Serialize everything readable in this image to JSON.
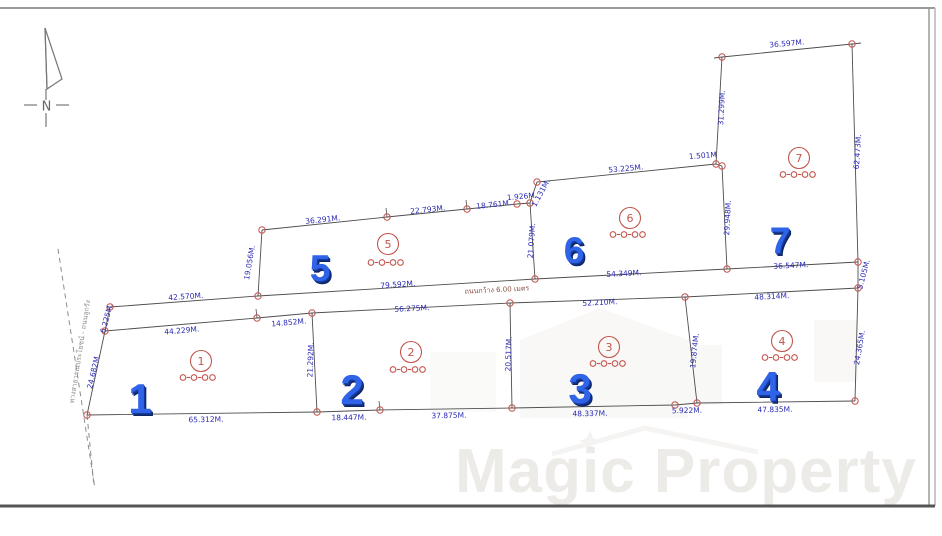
{
  "compass": {
    "label": "N"
  },
  "watermark": {
    "text": "Magic Property"
  },
  "roads": {
    "internal_road_label": "ถนนกว้าง 6.00 เมตร",
    "frontage_road_label": "ทางสาธารณประโยชน์ - ถนนลูกรัง"
  },
  "colors": {
    "dimension_text": "#2b2bb4",
    "survey_marker": "#c2554d",
    "plot_number_blue": "#2f63e8",
    "boundary_line": "#4d4d4d",
    "watermark_gray": "#edebe8"
  },
  "plots": [
    {
      "number": "1",
      "circled_number": "1",
      "area_rai_ngan_wah": "๐-๐-๐๐",
      "number_pos": [
        140,
        413
      ],
      "circle_pos": [
        201,
        361
      ],
      "area_pos": [
        200,
        380
      ]
    },
    {
      "number": "2",
      "circled_number": "2",
      "area_rai_ngan_wah": "๐-๐-๐๐",
      "number_pos": [
        352,
        404
      ],
      "circle_pos": [
        411,
        352
      ],
      "area_pos": [
        410,
        372
      ]
    },
    {
      "number": "3",
      "circled_number": "3",
      "area_rai_ngan_wah": "๐-๐-๐๐",
      "number_pos": [
        580,
        403
      ],
      "circle_pos": [
        609,
        347
      ],
      "area_pos": [
        610,
        366
      ]
    },
    {
      "number": "4",
      "circled_number": "4",
      "area_rai_ngan_wah": "๐-๐-๐๐",
      "number_pos": [
        768,
        401
      ],
      "circle_pos": [
        782,
        341
      ],
      "area_pos": [
        782,
        360
      ]
    },
    {
      "number": "5",
      "circled_number": "5",
      "area_rai_ngan_wah": "๐-๐-๐๐",
      "number_pos": [
        320,
        281
      ],
      "circle_pos": [
        388,
        244
      ],
      "area_pos": [
        388,
        265
      ]
    },
    {
      "number": "6",
      "circled_number": "6",
      "area_rai_ngan_wah": "๐-๐-๐๐",
      "number_pos": [
        574,
        263
      ],
      "circle_pos": [
        630,
        218
      ],
      "area_pos": [
        630,
        237
      ]
    },
    {
      "number": "7",
      "circled_number": "7",
      "area_rai_ngan_wah": "๐-๐-๐๐",
      "number_pos": [
        780,
        253
      ],
      "circle_pos": [
        799,
        158
      ],
      "area_pos": [
        800,
        177
      ]
    }
  ],
  "dimensions": [
    {
      "text": "42.570M.",
      "x": 186,
      "y": 299,
      "rot": -4
    },
    {
      "text": "79.592M.",
      "x": 398,
      "y": 287,
      "rot": -4
    },
    {
      "text": "54.349M.",
      "x": 624,
      "y": 276,
      "rot": -3
    },
    {
      "text": "36.547M.",
      "x": 791,
      "y": 268,
      "rot": -3
    },
    {
      "text": "44.229M.",
      "x": 182,
      "y": 333,
      "rot": -5
    },
    {
      "text": "14.852M.",
      "x": 289,
      "y": 325,
      "rot": -5
    },
    {
      "text": "56.275M.",
      "x": 412,
      "y": 311,
      "rot": -3
    },
    {
      "text": "52.210M.",
      "x": 600,
      "y": 305,
      "rot": -3
    },
    {
      "text": "48.314M.",
      "x": 772,
      "y": 299,
      "rot": -3
    },
    {
      "text": "65.312M.",
      "x": 206,
      "y": 422,
      "rot": -1
    },
    {
      "text": "18.447M.",
      "x": 349,
      "y": 420,
      "rot": -1
    },
    {
      "text": "37.875M.",
      "x": 449,
      "y": 418,
      "rot": -1
    },
    {
      "text": "48.337M.",
      "x": 590,
      "y": 416,
      "rot": -1
    },
    {
      "text": "5.922M.",
      "x": 687,
      "y": 413,
      "rot": -1
    },
    {
      "text": "47.835M.",
      "x": 775,
      "y": 412,
      "rot": -1
    },
    {
      "text": "36.291M.",
      "x": 323,
      "y": 222,
      "rot": -6
    },
    {
      "text": "22.793M.",
      "x": 428,
      "y": 212,
      "rot": -6
    },
    {
      "text": "18.761M.",
      "x": 494,
      "y": 207,
      "rot": -6
    },
    {
      "text": "1.926M",
      "x": 521,
      "y": 199,
      "rot": -5
    },
    {
      "text": "1.131M.",
      "x": 543,
      "y": 194,
      "rot": -62
    },
    {
      "text": "53.225M.",
      "x": 626,
      "y": 171,
      "rot": -5
    },
    {
      "text": "1.501M",
      "x": 703,
      "y": 158,
      "rot": -4
    },
    {
      "text": "36.597M.",
      "x": 787,
      "y": 46,
      "rot": -5
    },
    {
      "text": "19.056M.",
      "x": 252,
      "y": 263,
      "rot": -80
    },
    {
      "text": "24.682M.",
      "x": 96,
      "y": 372,
      "rot": -77
    },
    {
      "text": "6.225M.",
      "x": 109,
      "y": 319,
      "rot": -75
    },
    {
      "text": "21.292M.",
      "x": 313,
      "y": 360,
      "rot": -88
    },
    {
      "text": "20.517M.",
      "x": 511,
      "y": 354,
      "rot": -88
    },
    {
      "text": "19.874M.",
      "x": 697,
      "y": 351,
      "rot": -84
    },
    {
      "text": "24.365M.",
      "x": 862,
      "y": 348,
      "rot": -80
    },
    {
      "text": "21.079M.",
      "x": 534,
      "y": 241,
      "rot": -86
    },
    {
      "text": "29.948M.",
      "x": 730,
      "y": 218,
      "rot": -87
    },
    {
      "text": "31.299M.",
      "x": 724,
      "y": 108,
      "rot": -87
    },
    {
      "text": "62.473M.",
      "x": 860,
      "y": 152,
      "rot": -86
    },
    {
      "text": "5.105M.",
      "x": 866,
      "y": 275,
      "rot": -75
    }
  ]
}
